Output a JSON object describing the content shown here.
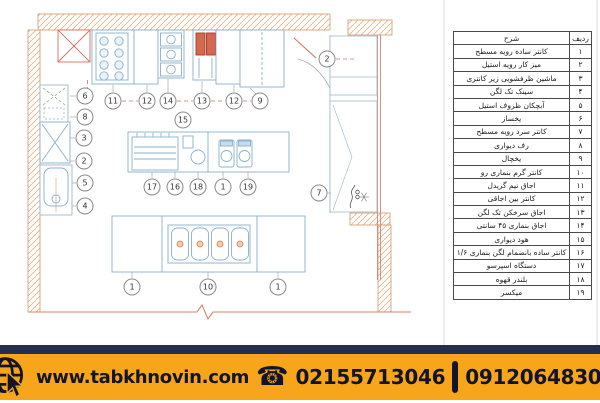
{
  "legend": {
    "header": {
      "row": "ردیف",
      "description": "شرح"
    },
    "rows": [
      {
        "no": "۱",
        "description": "کانتر ساده رویه مسطح"
      },
      {
        "no": "۲",
        "description": "میز کار رویه استیل"
      },
      {
        "no": "۳",
        "description": "ماشین ظرفشویی زیر کانتری"
      },
      {
        "no": "۴",
        "description": "سینک تک لگن"
      },
      {
        "no": "۵",
        "description": "آبچکان ظروف استیل"
      },
      {
        "no": "۶",
        "description": "یخساز"
      },
      {
        "no": "۷",
        "description": "کانتر سرد رویه مسطح"
      },
      {
        "no": "۸",
        "description": "رف دیواری"
      },
      {
        "no": "۹",
        "description": "یخچال"
      },
      {
        "no": "۱۰",
        "description": "کانتر گرم بنماری رو"
      },
      {
        "no": "۱۱",
        "description": "اجاق نیم گریدل"
      },
      {
        "no": "۱۲",
        "description": "کانتر بین اجاقی"
      },
      {
        "no": "۱۳",
        "description": "اجاق سرخکن تک لگن"
      },
      {
        "no": "۱۴",
        "description": "اجاق بنماری ۴۵ سانتی"
      },
      {
        "no": "۱۵",
        "description": "هود دیواری"
      },
      {
        "no": "۱۶",
        "description": "کانتر ساده بانضمام لگن بنماری ۱/۶"
      },
      {
        "no": "۱۷",
        "description": "دستگاه اسپرسو"
      },
      {
        "no": "۱۸",
        "description": "بلندر قهوه"
      },
      {
        "no": "۱۹",
        "description": "میکسر"
      }
    ]
  },
  "plan": {
    "callouts": [
      {
        "label": "6",
        "x": 85,
        "y": 96
      },
      {
        "label": "8",
        "x": 85,
        "y": 117
      },
      {
        "label": "3",
        "x": 84,
        "y": 138
      },
      {
        "label": "2",
        "x": 84,
        "y": 161
      },
      {
        "label": "5",
        "x": 85,
        "y": 183
      },
      {
        "label": "4",
        "x": 85,
        "y": 206
      },
      {
        "label": "11",
        "x": 113,
        "y": 101
      },
      {
        "label": "12",
        "x": 147,
        "y": 101
      },
      {
        "label": "14",
        "x": 168,
        "y": 101
      },
      {
        "label": "13",
        "x": 202,
        "y": 101
      },
      {
        "label": "12",
        "x": 234,
        "y": 101
      },
      {
        "label": "9",
        "x": 260,
        "y": 101
      },
      {
        "label": "15",
        "x": 183,
        "y": 120
      },
      {
        "label": "2",
        "x": 327,
        "y": 59
      },
      {
        "label": "7",
        "x": 319,
        "y": 193
      },
      {
        "label": "17",
        "x": 152,
        "y": 187
      },
      {
        "label": "16",
        "x": 175,
        "y": 187
      },
      {
        "label": "18",
        "x": 198,
        "y": 187
      },
      {
        "label": "1",
        "x": 223,
        "y": 187
      },
      {
        "label": "19",
        "x": 248,
        "y": 187
      },
      {
        "label": "1",
        "x": 132,
        "y": 287
      },
      {
        "label": "10",
        "x": 208,
        "y": 287
      },
      {
        "label": "1",
        "x": 278,
        "y": 287
      }
    ]
  },
  "banner": {
    "website": "www.tabkhnovin.com",
    "phone_landline": "02155713046",
    "phone_mobile": "09120648301",
    "icons": {
      "phone_glyph": "☎"
    },
    "colors": {
      "orange": "#f7a61c",
      "navy": "#262e4e",
      "text": "#12142a"
    }
  }
}
